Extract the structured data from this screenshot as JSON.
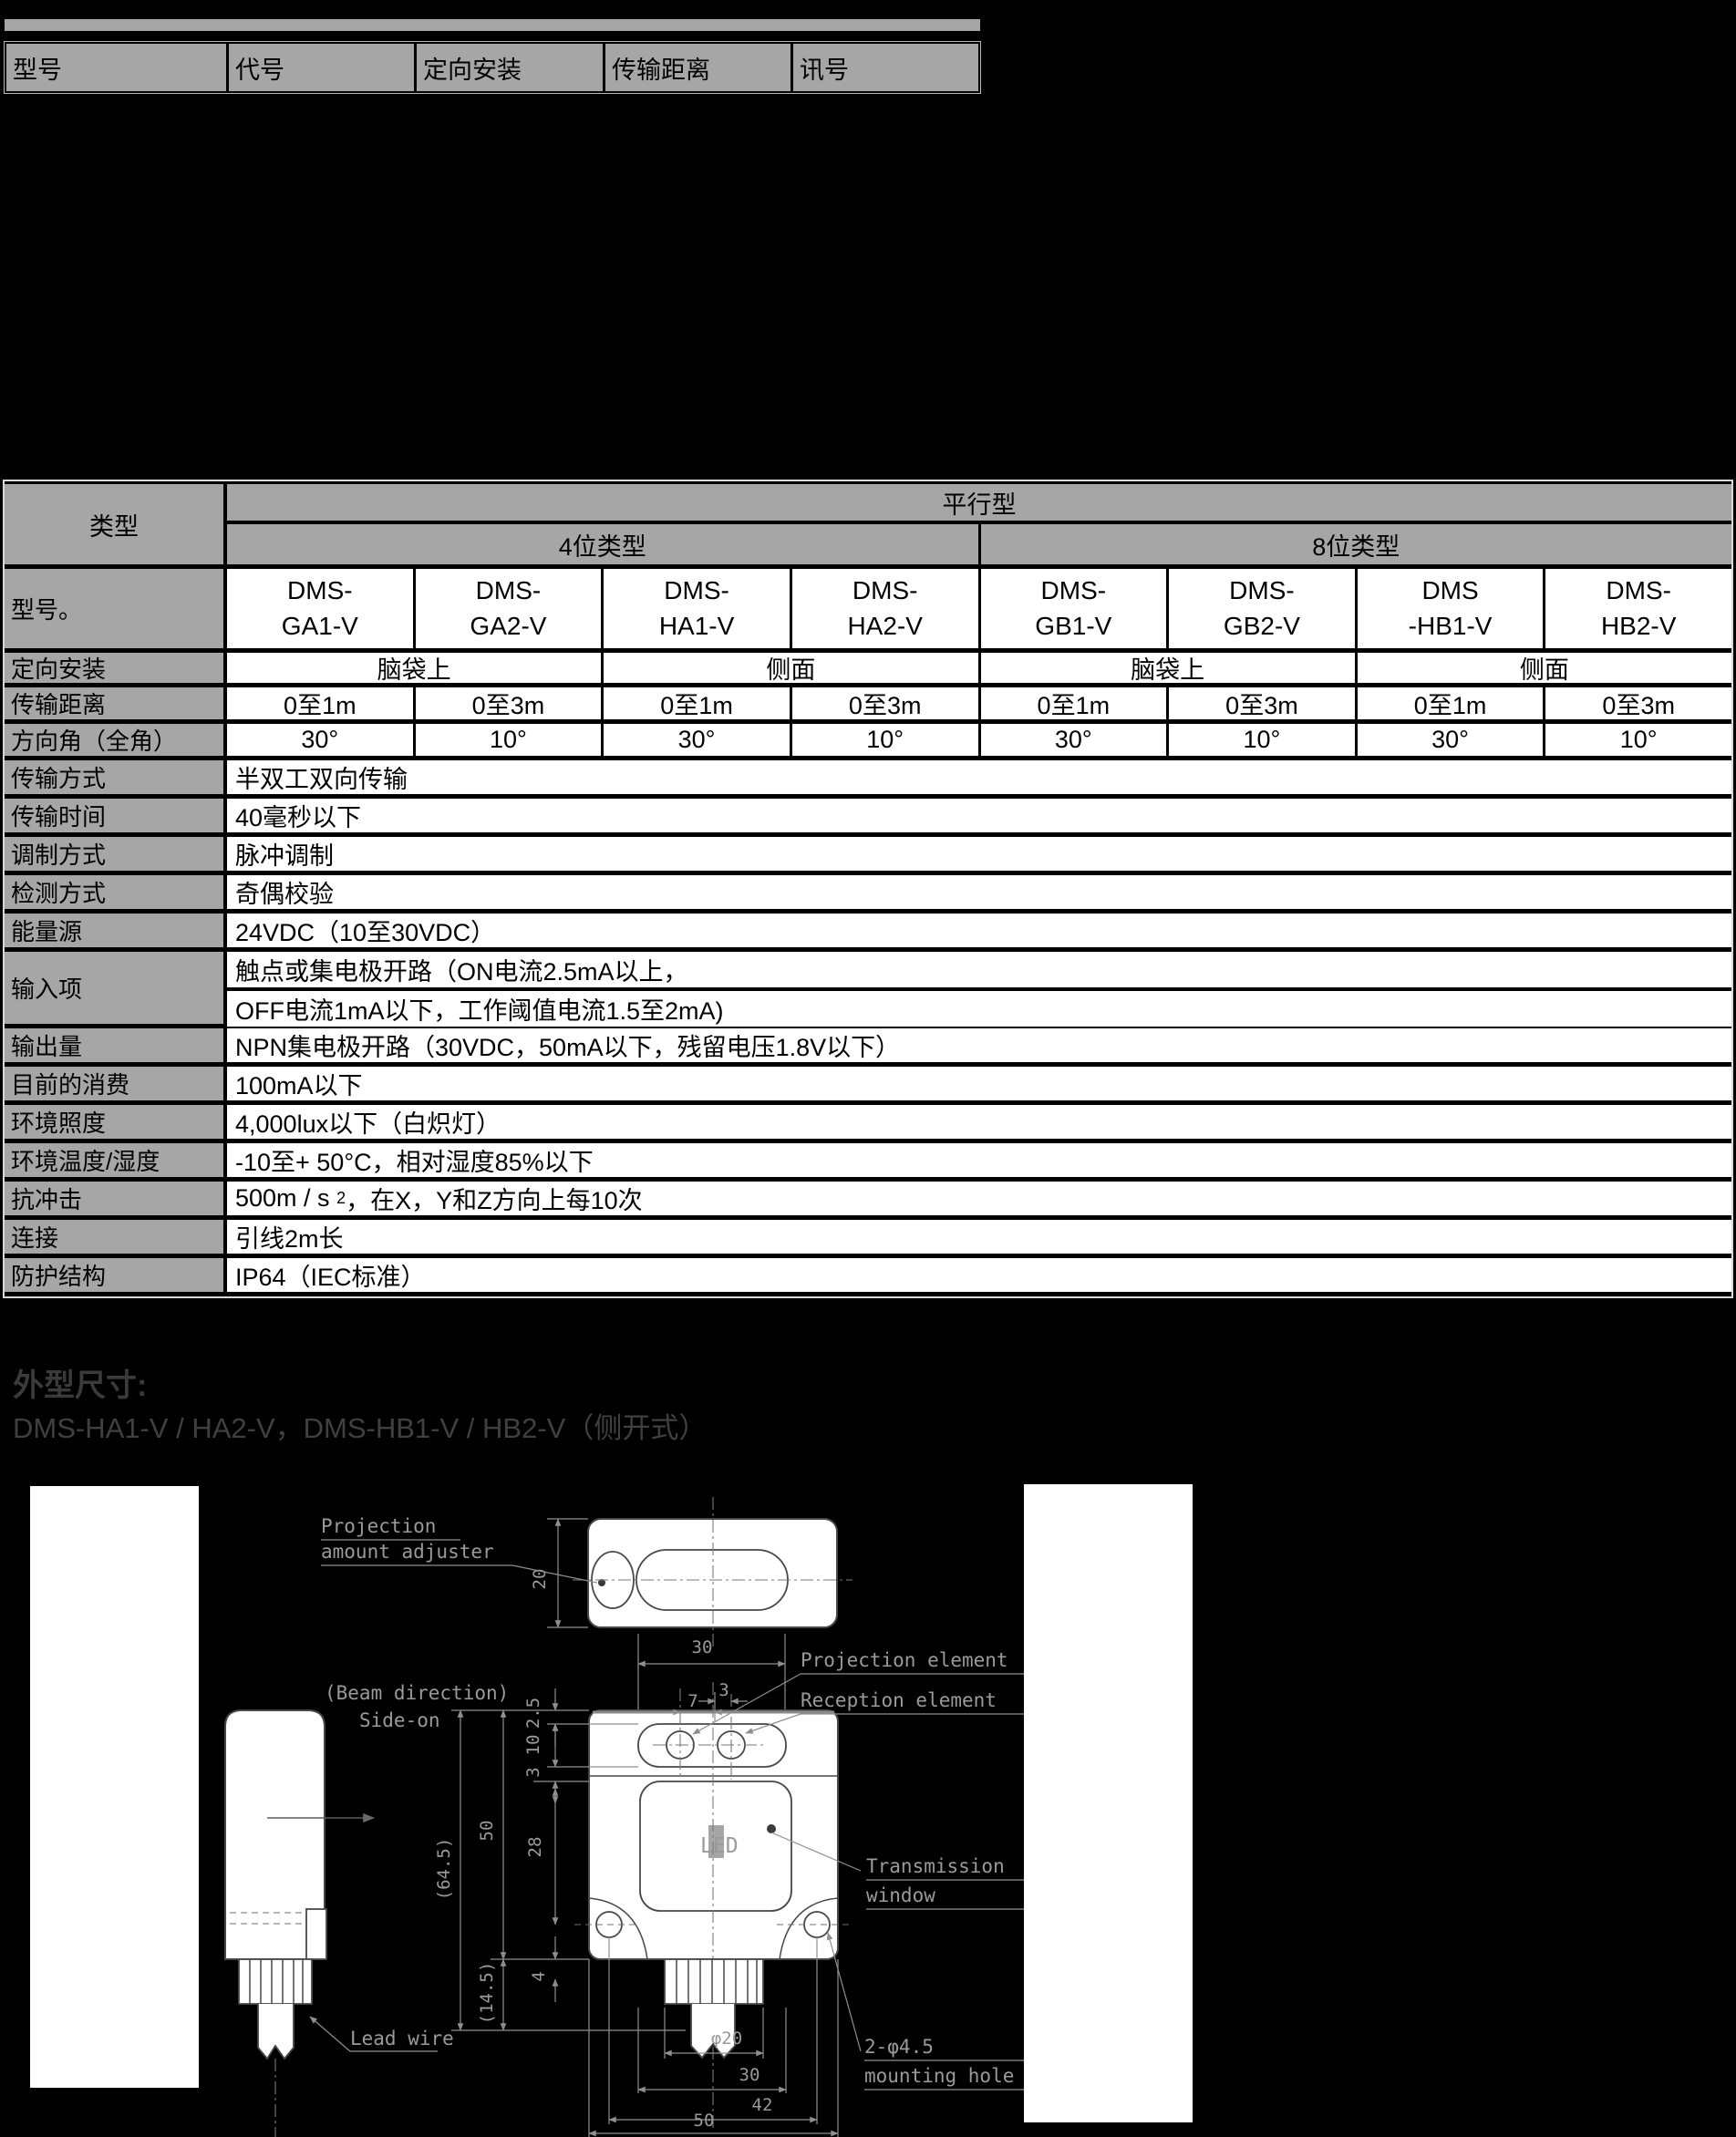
{
  "colors": {
    "background": "#000000",
    "table_header_gray": "#a6a6a6",
    "heading_gray": "#3a3a3a",
    "drawing_line_gray": "#8f8f8f"
  },
  "top_table": {
    "headers": [
      "型号",
      "代号",
      "定向安装",
      "传输距离",
      "讯号"
    ]
  },
  "spec_table": {
    "corner_label": "类型",
    "group_header": "平行型",
    "subgroups": [
      "4位类型",
      "8位类型"
    ],
    "model_row_label": "型号。",
    "models": [
      [
        "DMS-",
        "GA1-V"
      ],
      [
        "DMS-",
        "GA2-V"
      ],
      [
        "DMS-",
        "HA1-V"
      ],
      [
        "DMS-",
        "HA2-V"
      ],
      [
        "DMS-",
        "GB1-V"
      ],
      [
        "DMS-",
        "GB2-V"
      ],
      [
        "DMS",
        "-HB1-V"
      ],
      [
        "DMS-",
        "HB2-V"
      ]
    ],
    "orientation_label": "定向安装",
    "orientations": [
      "脑袋上",
      "侧面",
      "脑袋上",
      "侧面"
    ],
    "distance_label": "传输距离",
    "distances": [
      "0至1m",
      "0至3m",
      "0至1m",
      "0至3m",
      "0至1m",
      "0至3m",
      "0至1m",
      "0至3m"
    ],
    "angle_label": "方向角（全角）",
    "angles": [
      "30°",
      "10°",
      "30°",
      "10°",
      "30°",
      "10°",
      "30°",
      "10°"
    ],
    "rows": [
      {
        "label": "传输方式",
        "value": "半双工双向传输"
      },
      {
        "label": "传输时间",
        "value": "40毫秒以下"
      },
      {
        "label": "调制方式",
        "value": "脉冲调制"
      },
      {
        "label": "检测方式",
        "value": "奇偶校验"
      },
      {
        "label": "能量源",
        "value": "24VDC（10至30VDC）"
      },
      {
        "label": "输入项",
        "value": "触点或集电极开路（ON电流2.5mA以上，",
        "value2": "OFF电流1mA以下，工作阈值电流1.5至2mA)"
      },
      {
        "label": "输出量",
        "value": "NPN集电极开路（30VDC，50mA以下，残留电压1.8V以下）"
      },
      {
        "label": "目前的消费",
        "value": "100mA以下"
      },
      {
        "label": "环境照度",
        "value": "4,000lux以下（白炽灯）"
      },
      {
        "label": "环境温度/湿度",
        "value": "-10至+ 50°C，相对湿度85%以下"
      },
      {
        "label": "抗冲击",
        "value_pre": "500m / s",
        "value_sup": "2",
        "value_post": "，在X，Y和Z方向上每10次"
      },
      {
        "label": "连接",
        "value": "引线2m长"
      },
      {
        "label": "防护结构",
        "value": "IP64（IEC标准）"
      }
    ]
  },
  "dimensions_section": {
    "heading": "外型尺寸:",
    "subtitle": "DMS-HA1-V / HA2-V，DMS-HB1-V / HB2-V（侧开式）"
  },
  "drawing": {
    "labels": {
      "projection_adjuster_1": "Projection",
      "projection_adjuster_2": "amount adjuster",
      "beam_direction_1": "(Beam direction)",
      "beam_direction_2": "Side-on",
      "projection_element": "Projection element",
      "reception_element": "Reception element",
      "transmission_window_1": "Transmission",
      "transmission_window_2": "window",
      "mounting_hole_1": "2-φ4.5",
      "mounting_hole_2": "mounting hole",
      "lead_wire": "Lead wire",
      "led": "LED"
    },
    "dims": {
      "top_view_height": "20",
      "element_span_30": "30",
      "pitch_7": "7",
      "pitch_3": "3",
      "offset_2_5": "2.5",
      "slot_10": "10",
      "gap_3": "3",
      "window_28": "28",
      "body_height_50": "50",
      "overall_64_5": "(64.5)",
      "lead_4": "4",
      "lead_14_5": "(14.5)",
      "cable_dia": "φ20",
      "window_width_30": "30",
      "hole_pitch_42": "42",
      "body_width_50": "50"
    }
  }
}
